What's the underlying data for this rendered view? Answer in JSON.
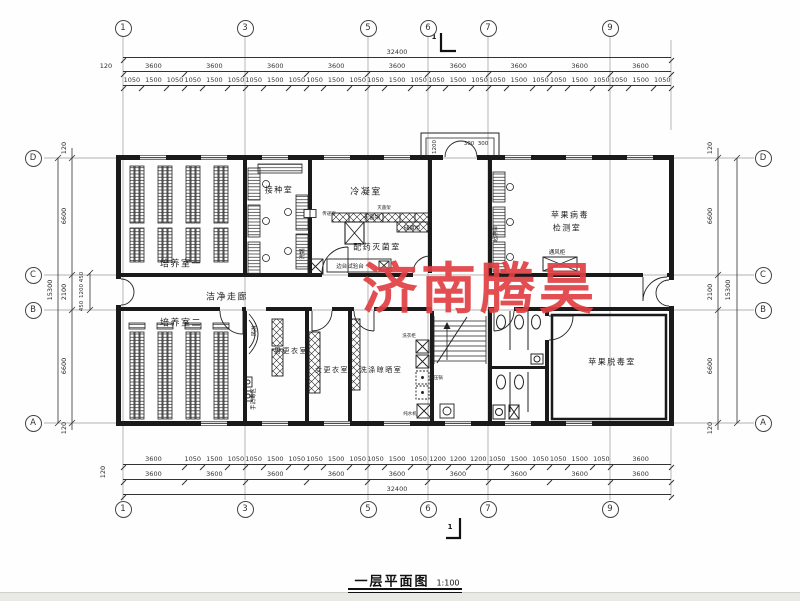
{
  "title": {
    "label": "一层平面图",
    "scale": "1:100"
  },
  "watermark": "济南腾昊",
  "section_mark": {
    "top": "1",
    "bottom": "1"
  },
  "grid": {
    "top": [
      "1",
      "3",
      "5",
      "6",
      "7",
      "9"
    ],
    "bottom": [
      "1",
      "3",
      "5",
      "6",
      "7",
      "9"
    ],
    "left": [
      "D",
      "C",
      "B",
      "A"
    ],
    "right": [
      "D",
      "C",
      "B",
      "A"
    ]
  },
  "dims": {
    "top": {
      "overall": "32400",
      "edge": "120",
      "bays": [
        "3600",
        "3600",
        "3600",
        "3600",
        "3600",
        "3600",
        "3600",
        "3600",
        "3600"
      ],
      "sub": [
        "1050",
        "1500",
        "1050",
        "1050",
        "1500",
        "1050",
        "1050",
        "1500",
        "1050",
        "1050",
        "1500",
        "1050",
        "1050",
        "1500",
        "1050",
        "1050",
        "1500",
        "1050",
        "1050",
        "1500",
        "1050",
        "1050",
        "1500",
        "1050",
        "1050",
        "1500",
        "1050"
      ]
    },
    "bottom": {
      "overall": "32400",
      "edge": "120",
      "bays": [
        "3600",
        "3600",
        "3600",
        "3600",
        "3600",
        "3600",
        "3600",
        "3600",
        "3600"
      ],
      "sub": [
        "3600",
        "1050",
        "1500",
        "1050",
        "1050",
        "1500",
        "1050",
        "1050",
        "1500",
        "1050",
        "1050",
        "1500",
        "1050",
        "1200",
        "1200",
        "1200",
        "1050",
        "1500",
        "1050",
        "1050",
        "1500",
        "1050",
        "3600"
      ]
    },
    "left": {
      "overall": "15300",
      "edge_top": "120",
      "edge_bottom": "120",
      "segments": [
        "6600",
        "2100",
        "6600"
      ],
      "corridor": [
        "450",
        "1200",
        "450"
      ]
    },
    "right": {
      "overall": "15300",
      "edge_top": "120",
      "edge_bottom": "120",
      "segments": [
        "6600",
        "2100",
        "6600"
      ]
    },
    "porch": {
      "depth": "1200",
      "offsets": [
        "300",
        "300"
      ]
    }
  },
  "rooms": {
    "culture_room_1": "培养室一",
    "inoculation_room": "接种室",
    "condensation_room": "冷凝室",
    "dispensing_sterilization_room": "配药灭菌室",
    "virus_detection_line1": "苹果病毒",
    "virus_detection_line2": "检测室",
    "clean_corridor": "洁净走廊",
    "culture_room_2": "培养室二",
    "men_changing_room": "男更衣室",
    "women_changing_room": "女更衣室",
    "washing_drying_room": "洗涤晾晒室",
    "virus_free_room": "苹果脱毒室"
  },
  "equipment": {
    "sterilizer_pot": "灭菌锅",
    "sterilizer_rack": "灭菌架",
    "storage_cabinet": "储藏柜",
    "side_test_bench": "边台试验台",
    "wash_sink": "洗锅",
    "pass_window": "传递窗",
    "clean_bench": "超净台",
    "fume_hood": "通风柜",
    "air_shower": "风淋",
    "hand_disinfection": "手消毒区",
    "wash_cabinet": "洗衣柜",
    "autoclave": "高压锅",
    "water_purifier": "纯水机"
  }
}
